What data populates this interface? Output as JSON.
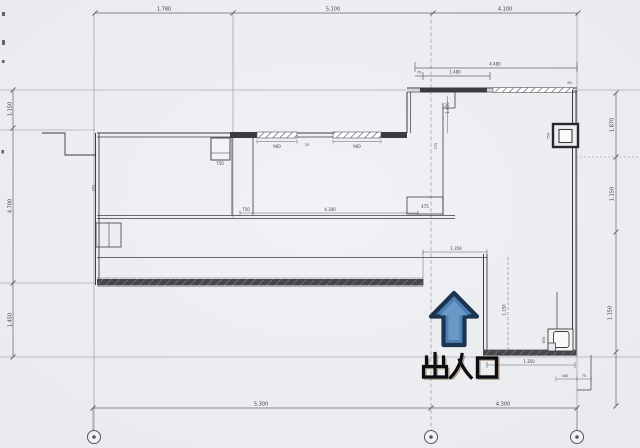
{
  "plan": {
    "kind": "architectural-floor-plan-scan",
    "entrance_label": "出入口",
    "colors": {
      "paper": "#eff0f3",
      "line": "#62646a",
      "grid": "#8b8d92",
      "wall": "#3b3c40",
      "wall_fill": "#46474b",
      "arrow_fill": "#4d7fb6",
      "arrow_highlight": "#6f9cc9",
      "arrow_outline": "#1b3450",
      "label_text": "#0d0d0f"
    },
    "dims": {
      "top_left": "1.780",
      "top_mid": "5.100",
      "top_right": "4.100",
      "bottom_left": "5.300",
      "bottom_right": "4.300",
      "left_upper": "1.150",
      "left_mid": "4.700",
      "left_lower": "1.450",
      "right_upper": "1.870",
      "right_mid": "1.150",
      "right_lower": "1.150",
      "wing_total": "4.480",
      "wing_partial": "1.480",
      "wing_small_a": "70",
      "wing_small_b": "90",
      "entry_width": "1.350",
      "wc_width": "1.350",
      "wc_depth": "1.150",
      "wc_fixture": "850",
      "column_size": "750",
      "step_a": "440",
      "step_b": "75",
      "room_upper_h": "1.450",
      "room_upper_w": "275",
      "closet": "750",
      "win_left": "900",
      "win_right": "900",
      "win_gap": "25",
      "hall_left": "750",
      "hall_width": "4.300",
      "hall_right": "475",
      "wall_note": "250"
    }
  }
}
